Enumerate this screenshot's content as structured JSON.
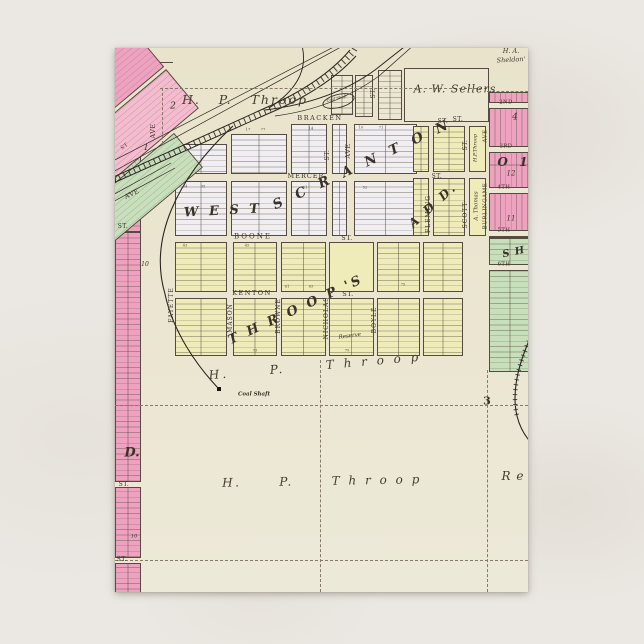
{
  "postcard": {
    "colors": {
      "map_background": "#ece7d2",
      "pink": "#efa2c0",
      "pink_light": "#f5bcd0",
      "green": "#c8dfbc",
      "yellow": "#f0ecba",
      "lavender": "#f1eef1",
      "ink": "#3b332a",
      "rail": "#2b2620",
      "scene_background": "#ebe8e3"
    },
    "labels": [
      {
        "id": "owner-throop-top",
        "text": "H.   P.   Throop",
        "x": 130,
        "y": 52,
        "s": 12.5,
        "r": 0,
        "ls": 2,
        "sc": 1,
        "cls": "owner"
      },
      {
        "id": "owner-sellers",
        "text": "A. W. Sellers",
        "x": 340,
        "y": 41,
        "s": 11,
        "r": 0,
        "ls": 1,
        "sc": 1,
        "cls": "owner"
      },
      {
        "id": "owner-sheldon-line1",
        "text": "H. A.",
        "x": 396,
        "y": 3,
        "s": 6.5,
        "r": 0,
        "ls": 0,
        "sc": 1,
        "cls": "owner"
      },
      {
        "id": "owner-sheldon-line2",
        "text": "Sheldon'",
        "x": 396,
        "y": 12,
        "s": 6.5,
        "r": -3,
        "ls": 0,
        "sc": 1,
        "cls": "owner"
      },
      {
        "id": "coal-shaft-top-label",
        "text": "Coal Shaft",
        "x": 222,
        "y": 52,
        "s": 4.8,
        "r": -14,
        "ls": 0,
        "sc": 0.8,
        "cls": "tiny-it"
      },
      {
        "id": "coal-shaft-mid-label",
        "text": "Coal Shaft",
        "x": 139,
        "y": 347,
        "s": 5.5,
        "r": 0,
        "ls": 0,
        "sc": 1,
        "cls": "tiny-it bold"
      },
      {
        "id": "owner-throop-mid",
        "text": "H.      P.      T h r o o p",
        "x": 200,
        "y": 318,
        "s": 12,
        "r": -5,
        "ls": 3,
        "sc": 1,
        "cls": "owner"
      },
      {
        "id": "owner-throop-bottom",
        "text": "H.      P.      T h r o o p",
        "x": 207,
        "y": 433,
        "s": 12,
        "r": -1,
        "ls": 2.5,
        "sc": 1,
        "cls": "owner"
      },
      {
        "id": "owner-re-bottom",
        "text": "R e",
        "x": 398,
        "y": 428,
        "s": 12,
        "r": 0,
        "ls": 1,
        "sc": 1,
        "cls": "owner"
      },
      {
        "id": "big-west",
        "text": "W E S T",
        "x": 108,
        "y": 163,
        "s": 13,
        "r": -3,
        "ls": 3,
        "sc": 1,
        "cls": "big"
      },
      {
        "id": "big-scranton",
        "text": "S C R A N T O N",
        "x": 248,
        "y": 117,
        "s": 13.5,
        "r": -25,
        "ls": 5,
        "sc": 1,
        "cls": "big"
      },
      {
        "id": "big-add",
        "text": "A D D.",
        "x": 318,
        "y": 157,
        "s": 12,
        "r": -42,
        "ls": 3,
        "sc": 1,
        "cls": "big"
      },
      {
        "id": "big-throops",
        "text": "T H R O O P 'S",
        "x": 181,
        "y": 262,
        "s": 13,
        "r": -25,
        "ls": 3,
        "sc": 1,
        "cls": "big"
      },
      {
        "id": "big-d-left",
        "text": "D.",
        "x": 17,
        "y": 405,
        "s": 13,
        "r": 0,
        "ls": 0,
        "sc": 1,
        "cls": "big"
      },
      {
        "id": "big-o-right",
        "text": "O  1",
        "x": 398,
        "y": 114,
        "s": 12,
        "r": 0,
        "ls": 1,
        "sc": 1,
        "cls": "big"
      },
      {
        "id": "big-sh-right",
        "text": "S H",
        "x": 399,
        "y": 205,
        "s": 10,
        "r": -12,
        "ls": 1,
        "sc": 1,
        "cls": "big"
      },
      {
        "id": "reserve-label",
        "text": "Reserve",
        "x": 235,
        "y": 289,
        "s": 5.5,
        "r": -8,
        "ls": 0,
        "sc": 1,
        "cls": "tiny-it"
      },
      {
        "id": "athomas-label",
        "text": "A. Thomas",
        "x": 362,
        "y": 158,
        "s": 5.5,
        "r": -90,
        "ls": 0,
        "sc": 1,
        "cls": "tiny-it"
      },
      {
        "id": "hpthroop-block-label",
        "text": "H.P.Throop",
        "x": 361,
        "y": 100,
        "s": 5,
        "r": -90,
        "ls": 0,
        "sc": 1,
        "cls": "tiny-it"
      },
      {
        "id": "street-bracken",
        "text": "BRACKEN",
        "x": 205,
        "y": 70,
        "s": 6.5,
        "r": 0,
        "ls": 1.5,
        "sc": 1,
        "cls": "street"
      },
      {
        "id": "street-bracken-st",
        "text": "ST.",
        "x": 343,
        "y": 72,
        "s": 6,
        "r": 0,
        "ls": 0,
        "sc": 1,
        "cls": "street"
      },
      {
        "id": "street-mercer",
        "text": "MERCER",
        "x": 191,
        "y": 128,
        "s": 6.5,
        "r": 0,
        "ls": 1,
        "sc": 1,
        "cls": "street"
      },
      {
        "id": "street-boone",
        "text": "BOONE",
        "x": 138,
        "y": 189,
        "s": 7,
        "r": 0,
        "ls": 2,
        "sc": 1,
        "cls": "street"
      },
      {
        "id": "street-boone-st",
        "text": "ST.",
        "x": 232,
        "y": 190,
        "s": 6.5,
        "r": 0,
        "ls": 0,
        "sc": 1,
        "cls": "street"
      },
      {
        "id": "street-kenton",
        "text": "KENTON",
        "x": 137,
        "y": 245,
        "s": 6.5,
        "r": 0,
        "ls": 1.5,
        "sc": 1,
        "cls": "street"
      },
      {
        "id": "street-kenton-st",
        "text": "ST.",
        "x": 233,
        "y": 246,
        "s": 6.5,
        "r": 0,
        "ls": 0,
        "sc": 1,
        "cls": "street"
      },
      {
        "id": "street-fayette",
        "text": "FAYETTE",
        "x": 57,
        "y": 257,
        "s": 6,
        "r": -90,
        "ls": 1,
        "sc": 1,
        "cls": "street"
      },
      {
        "id": "street-mason",
        "text": "MASON",
        "x": 116,
        "y": 270,
        "s": 6,
        "r": -90,
        "ls": 1,
        "sc": 1,
        "cls": "street"
      },
      {
        "id": "street-browne",
        "text": "BROWNE",
        "x": 164,
        "y": 268,
        "s": 6,
        "r": -90,
        "ls": 1,
        "sc": 1,
        "cls": "street"
      },
      {
        "id": "street-nicholas",
        "text": "NICHOLAS",
        "x": 212,
        "y": 270,
        "s": 6,
        "r": -90,
        "ls": 1,
        "sc": 1,
        "cls": "street"
      },
      {
        "id": "street-boyle",
        "text": "BOYLE",
        "x": 260,
        "y": 272,
        "s": 6,
        "r": -90,
        "ls": 1,
        "sc": 1,
        "cls": "street"
      },
      {
        "id": "street-fleming",
        "text": "FLEMING",
        "x": 314,
        "y": 166,
        "s": 6,
        "r": -90,
        "ls": 1,
        "sc": 1,
        "cls": "street"
      },
      {
        "id": "street-scott",
        "text": "SCOTT",
        "x": 351,
        "y": 167,
        "s": 6,
        "r": -90,
        "ls": 1,
        "sc": 1,
        "cls": "street"
      },
      {
        "id": "street-scott-st",
        "text": "ST.",
        "x": 351,
        "y": 97,
        "s": 6,
        "r": -90,
        "ls": 0,
        "sc": 1,
        "cls": "street"
      },
      {
        "id": "street-burlingame",
        "text": "BURLINGAME",
        "x": 371,
        "y": 158,
        "s": 5.5,
        "r": -90,
        "ls": 0.5,
        "sc": 1,
        "cls": "street"
      },
      {
        "id": "street-burlingame-ave",
        "text": "AVE",
        "x": 371,
        "y": 88,
        "s": 5.5,
        "r": -90,
        "ls": 0,
        "sc": 1,
        "cls": "street"
      },
      {
        "id": "street-ave-central",
        "text": "AVE",
        "x": 233,
        "y": 103,
        "s": 6.5,
        "r": -90,
        "ls": 0,
        "sc": 1,
        "cls": "street"
      },
      {
        "id": "street-st-central-v",
        "text": "ST.",
        "x": 213,
        "y": 107,
        "s": 6,
        "r": -90,
        "ls": 0,
        "sc": 1,
        "cls": "street"
      },
      {
        "id": "street-st-top-v",
        "text": "ST.",
        "x": 259,
        "y": 45,
        "s": 6,
        "r": -90,
        "ls": 0,
        "sc": 1,
        "cls": "street"
      },
      {
        "id": "street-st-below-sellers",
        "text": "ST.",
        "x": 328,
        "y": 74,
        "s": 6,
        "r": 0,
        "ls": 0,
        "sc": 1,
        "cls": "street"
      },
      {
        "id": "street-st-fleming-row",
        "text": "ST.",
        "x": 322,
        "y": 129,
        "s": 6,
        "r": 0,
        "ls": 0,
        "sc": 1,
        "cls": "street"
      },
      {
        "id": "street-st-left-1",
        "text": "ST.",
        "x": 8,
        "y": 179,
        "s": 6,
        "r": 0,
        "ls": 0,
        "sc": 1,
        "cls": "street"
      },
      {
        "id": "street-st-left-2",
        "text": "ST.",
        "x": 9,
        "y": 437,
        "s": 6,
        "r": 0,
        "ls": 0,
        "sc": 1,
        "cls": "street"
      },
      {
        "id": "street-st-left-3",
        "text": "ST.",
        "x": 7,
        "y": 512,
        "s": 6,
        "r": 0,
        "ls": 0,
        "sc": 1,
        "cls": "street"
      },
      {
        "id": "street-st-green-left",
        "text": "ST",
        "x": 10,
        "y": 99,
        "s": 5,
        "r": -38,
        "ls": 0,
        "sc": 1,
        "cls": "street"
      },
      {
        "id": "street-ave-left-diag",
        "text": "AVE",
        "x": 17,
        "y": 146,
        "s": 6.5,
        "r": -25,
        "ls": 0,
        "sc": 1,
        "cls": "street"
      },
      {
        "id": "street-ave-left-v",
        "text": "AVE",
        "x": 38,
        "y": 83,
        "s": 6.5,
        "r": -90,
        "ls": 0,
        "sc": 1,
        "cls": "street"
      },
      {
        "id": "street-2nd",
        "text": "2ND",
        "x": 391,
        "y": 55,
        "s": 5.2,
        "r": 0,
        "ls": 0,
        "sc": 1,
        "cls": "street"
      },
      {
        "id": "street-3rd",
        "text": "3RD",
        "x": 391,
        "y": 99,
        "s": 5.2,
        "r": 0,
        "ls": 0,
        "sc": 1,
        "cls": "street"
      },
      {
        "id": "street-4th",
        "text": "4TH",
        "x": 389,
        "y": 140,
        "s": 5.2,
        "r": 0,
        "ls": 0,
        "sc": 1,
        "cls": "street"
      },
      {
        "id": "street-5th",
        "text": "5TH",
        "x": 389,
        "y": 183,
        "s": 5.2,
        "r": 0,
        "ls": 0,
        "sc": 1,
        "cls": "street"
      },
      {
        "id": "street-6th",
        "text": "6TH",
        "x": 389,
        "y": 217,
        "s": 5.2,
        "r": 0,
        "ls": 0,
        "sc": 1,
        "cls": "street"
      },
      {
        "id": "num-2",
        "text": "2",
        "x": 58,
        "y": 59,
        "s": 9,
        "r": 0,
        "ls": 0,
        "sc": 1,
        "cls": "num-it"
      },
      {
        "id": "num-1",
        "text": "1",
        "x": 31,
        "y": 100,
        "s": 8,
        "r": 0,
        "ls": 0,
        "sc": 1,
        "cls": "num-it"
      },
      {
        "id": "num-10-left",
        "text": "10",
        "x": 30,
        "y": 217,
        "s": 6,
        "r": 0,
        "ls": 0,
        "sc": 1,
        "cls": "num-it"
      },
      {
        "id": "num-10b-left",
        "text": "10",
        "x": 19,
        "y": 489,
        "s": 5,
        "r": 0,
        "ls": 0,
        "sc": 1,
        "cls": "num-it"
      },
      {
        "id": "num-12-right",
        "text": "12",
        "x": 396,
        "y": 126,
        "s": 7,
        "r": 0,
        "ls": 0,
        "sc": 1,
        "cls": "num-it"
      },
      {
        "id": "num-11-right",
        "text": "11",
        "x": 396,
        "y": 171,
        "s": 7,
        "r": 0,
        "ls": 0,
        "sc": 1,
        "cls": "num-it"
      },
      {
        "id": "num-4-right",
        "text": "4",
        "x": 400,
        "y": 70,
        "s": 9,
        "r": 0,
        "ls": 0,
        "sc": 1,
        "cls": "num-it"
      },
      {
        "id": "section-number-3",
        "text": "3",
        "x": 372,
        "y": 353,
        "s": 11,
        "r": 0,
        "ls": 0,
        "sc": 1,
        "cls": "secnum"
      },
      {
        "id": "lot-17",
        "text": "17",
        "x": 133,
        "y": 82,
        "s": 6,
        "r": 0,
        "ls": 0,
        "sc": 0.62,
        "cls": "lot"
      },
      {
        "id": "lot-77",
        "text": "77",
        "x": 148,
        "y": 82,
        "s": 6,
        "r": 0,
        "ls": 0,
        "sc": 0.62,
        "cls": "lot"
      },
      {
        "id": "lot-14",
        "text": "14",
        "x": 196,
        "y": 81,
        "s": 6,
        "r": 0,
        "ls": 0,
        "sc": 0.62,
        "cls": "lot"
      },
      {
        "id": "lot-10",
        "text": "10",
        "x": 246,
        "y": 80,
        "s": 6,
        "r": 0,
        "ls": 0,
        "sc": 0.62,
        "cls": "lot"
      },
      {
        "id": "lot-71",
        "text": "71",
        "x": 266,
        "y": 80,
        "s": 6,
        "r": 0,
        "ls": 0,
        "sc": 0.62,
        "cls": "lot"
      },
      {
        "id": "lot-34",
        "text": "34",
        "x": 70,
        "y": 139,
        "s": 6,
        "r": 0,
        "ls": 0,
        "sc": 0.62,
        "cls": "lot"
      },
      {
        "id": "lot-35",
        "text": "35",
        "x": 88,
        "y": 139,
        "s": 6,
        "r": 0,
        "ls": 0,
        "sc": 0.62,
        "cls": "lot"
      },
      {
        "id": "lot-51",
        "text": "51",
        "x": 190,
        "y": 140,
        "s": 6,
        "r": 0,
        "ls": 0,
        "sc": 0.62,
        "cls": "lot"
      },
      {
        "id": "lot-52",
        "text": "52",
        "x": 250,
        "y": 140,
        "s": 6,
        "r": 0,
        "ls": 0,
        "sc": 0.62,
        "cls": "lot"
      },
      {
        "id": "lot-43",
        "text": "43",
        "x": 70,
        "y": 198,
        "s": 6,
        "r": 0,
        "ls": 0,
        "sc": 0.62,
        "cls": "lot"
      },
      {
        "id": "lot-45",
        "text": "45",
        "x": 132,
        "y": 198,
        "s": 6,
        "r": 0,
        "ls": 0,
        "sc": 0.62,
        "cls": "lot"
      },
      {
        "id": "lot-61",
        "text": "61",
        "x": 172,
        "y": 239,
        "s": 6,
        "r": 0,
        "ls": 0,
        "sc": 0.62,
        "cls": "lot"
      },
      {
        "id": "lot-63",
        "text": "63",
        "x": 196,
        "y": 239,
        "s": 6,
        "r": 0,
        "ls": 0,
        "sc": 0.62,
        "cls": "lot"
      },
      {
        "id": "lot-75",
        "text": "75",
        "x": 288,
        "y": 237,
        "s": 6,
        "r": 0,
        "ls": 0,
        "sc": 0.62,
        "cls": "lot"
      },
      {
        "id": "lot-73",
        "text": "73",
        "x": 140,
        "y": 303,
        "s": 6,
        "r": 0,
        "ls": 0,
        "sc": 0.62,
        "cls": "lot"
      },
      {
        "id": "lot-79",
        "text": "79",
        "x": 232,
        "y": 303,
        "s": 6,
        "r": 0,
        "ls": 0,
        "sc": 0.62,
        "cls": "lot"
      }
    ]
  }
}
